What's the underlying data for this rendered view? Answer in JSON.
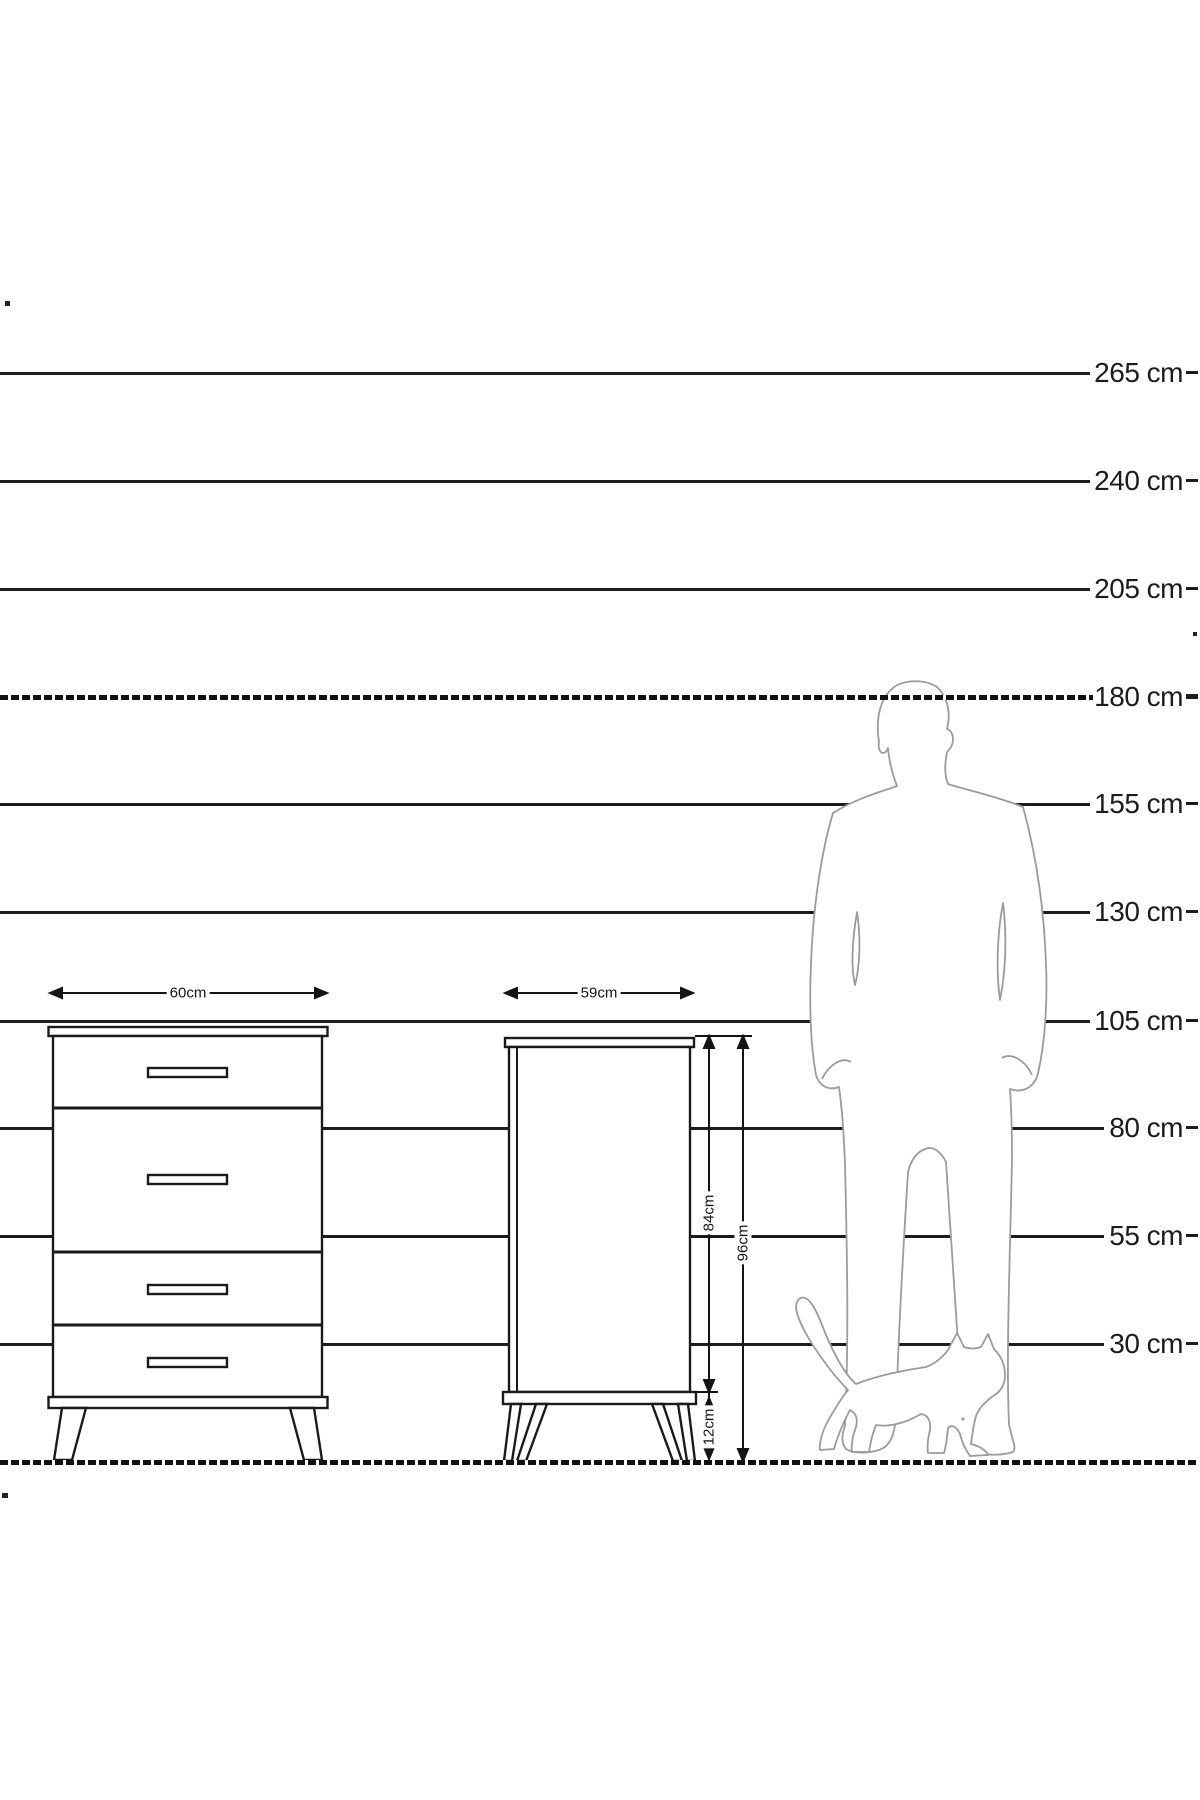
{
  "figure": {
    "kind": "furniture height comparison diagram",
    "units": "cm",
    "line_color": "#1c1c1c",
    "silhouette_color": "#9b9b9b"
  },
  "scale_lines": [
    {
      "label": "265 cm",
      "y": 373,
      "line_end": 1090,
      "style": "solid"
    },
    {
      "label": "240 cm",
      "y": 481,
      "line_end": 1090,
      "style": "solid"
    },
    {
      "label": "205 cm",
      "y": 589,
      "line_end": 1090,
      "style": "solid"
    },
    {
      "label": "180 cm",
      "y": 697,
      "line_end": 1093,
      "style": "dashed"
    },
    {
      "label": "155 cm",
      "y": 804,
      "line_end": 1090,
      "style": "solid"
    },
    {
      "label": "130 cm",
      "y": 912,
      "line_end": 1090,
      "style": "solid"
    },
    {
      "label": "105 cm",
      "y": 1021,
      "line_end": 1090,
      "style": "solid"
    },
    {
      "label": "80 cm",
      "y": 1128,
      "line_end": 1104,
      "style": "solid"
    },
    {
      "label": "55 cm",
      "y": 1236,
      "line_end": 1104,
      "style": "solid"
    },
    {
      "label": "30 cm",
      "y": 1344,
      "line_end": 1104,
      "style": "solid"
    }
  ],
  "ground": {
    "y": 1462,
    "style": "dashed-thick"
  },
  "dimensions": {
    "front_width": "60cm",
    "side_width": "59cm",
    "body_height": "84cm",
    "total_height": "96cm",
    "leg_height": "12cm"
  },
  "furniture": {
    "front_view": {
      "drawers": 4,
      "handles": 4,
      "legs": 2
    },
    "side_view": {
      "legs": 2
    }
  },
  "silhouettes": [
    "man",
    "cat"
  ]
}
